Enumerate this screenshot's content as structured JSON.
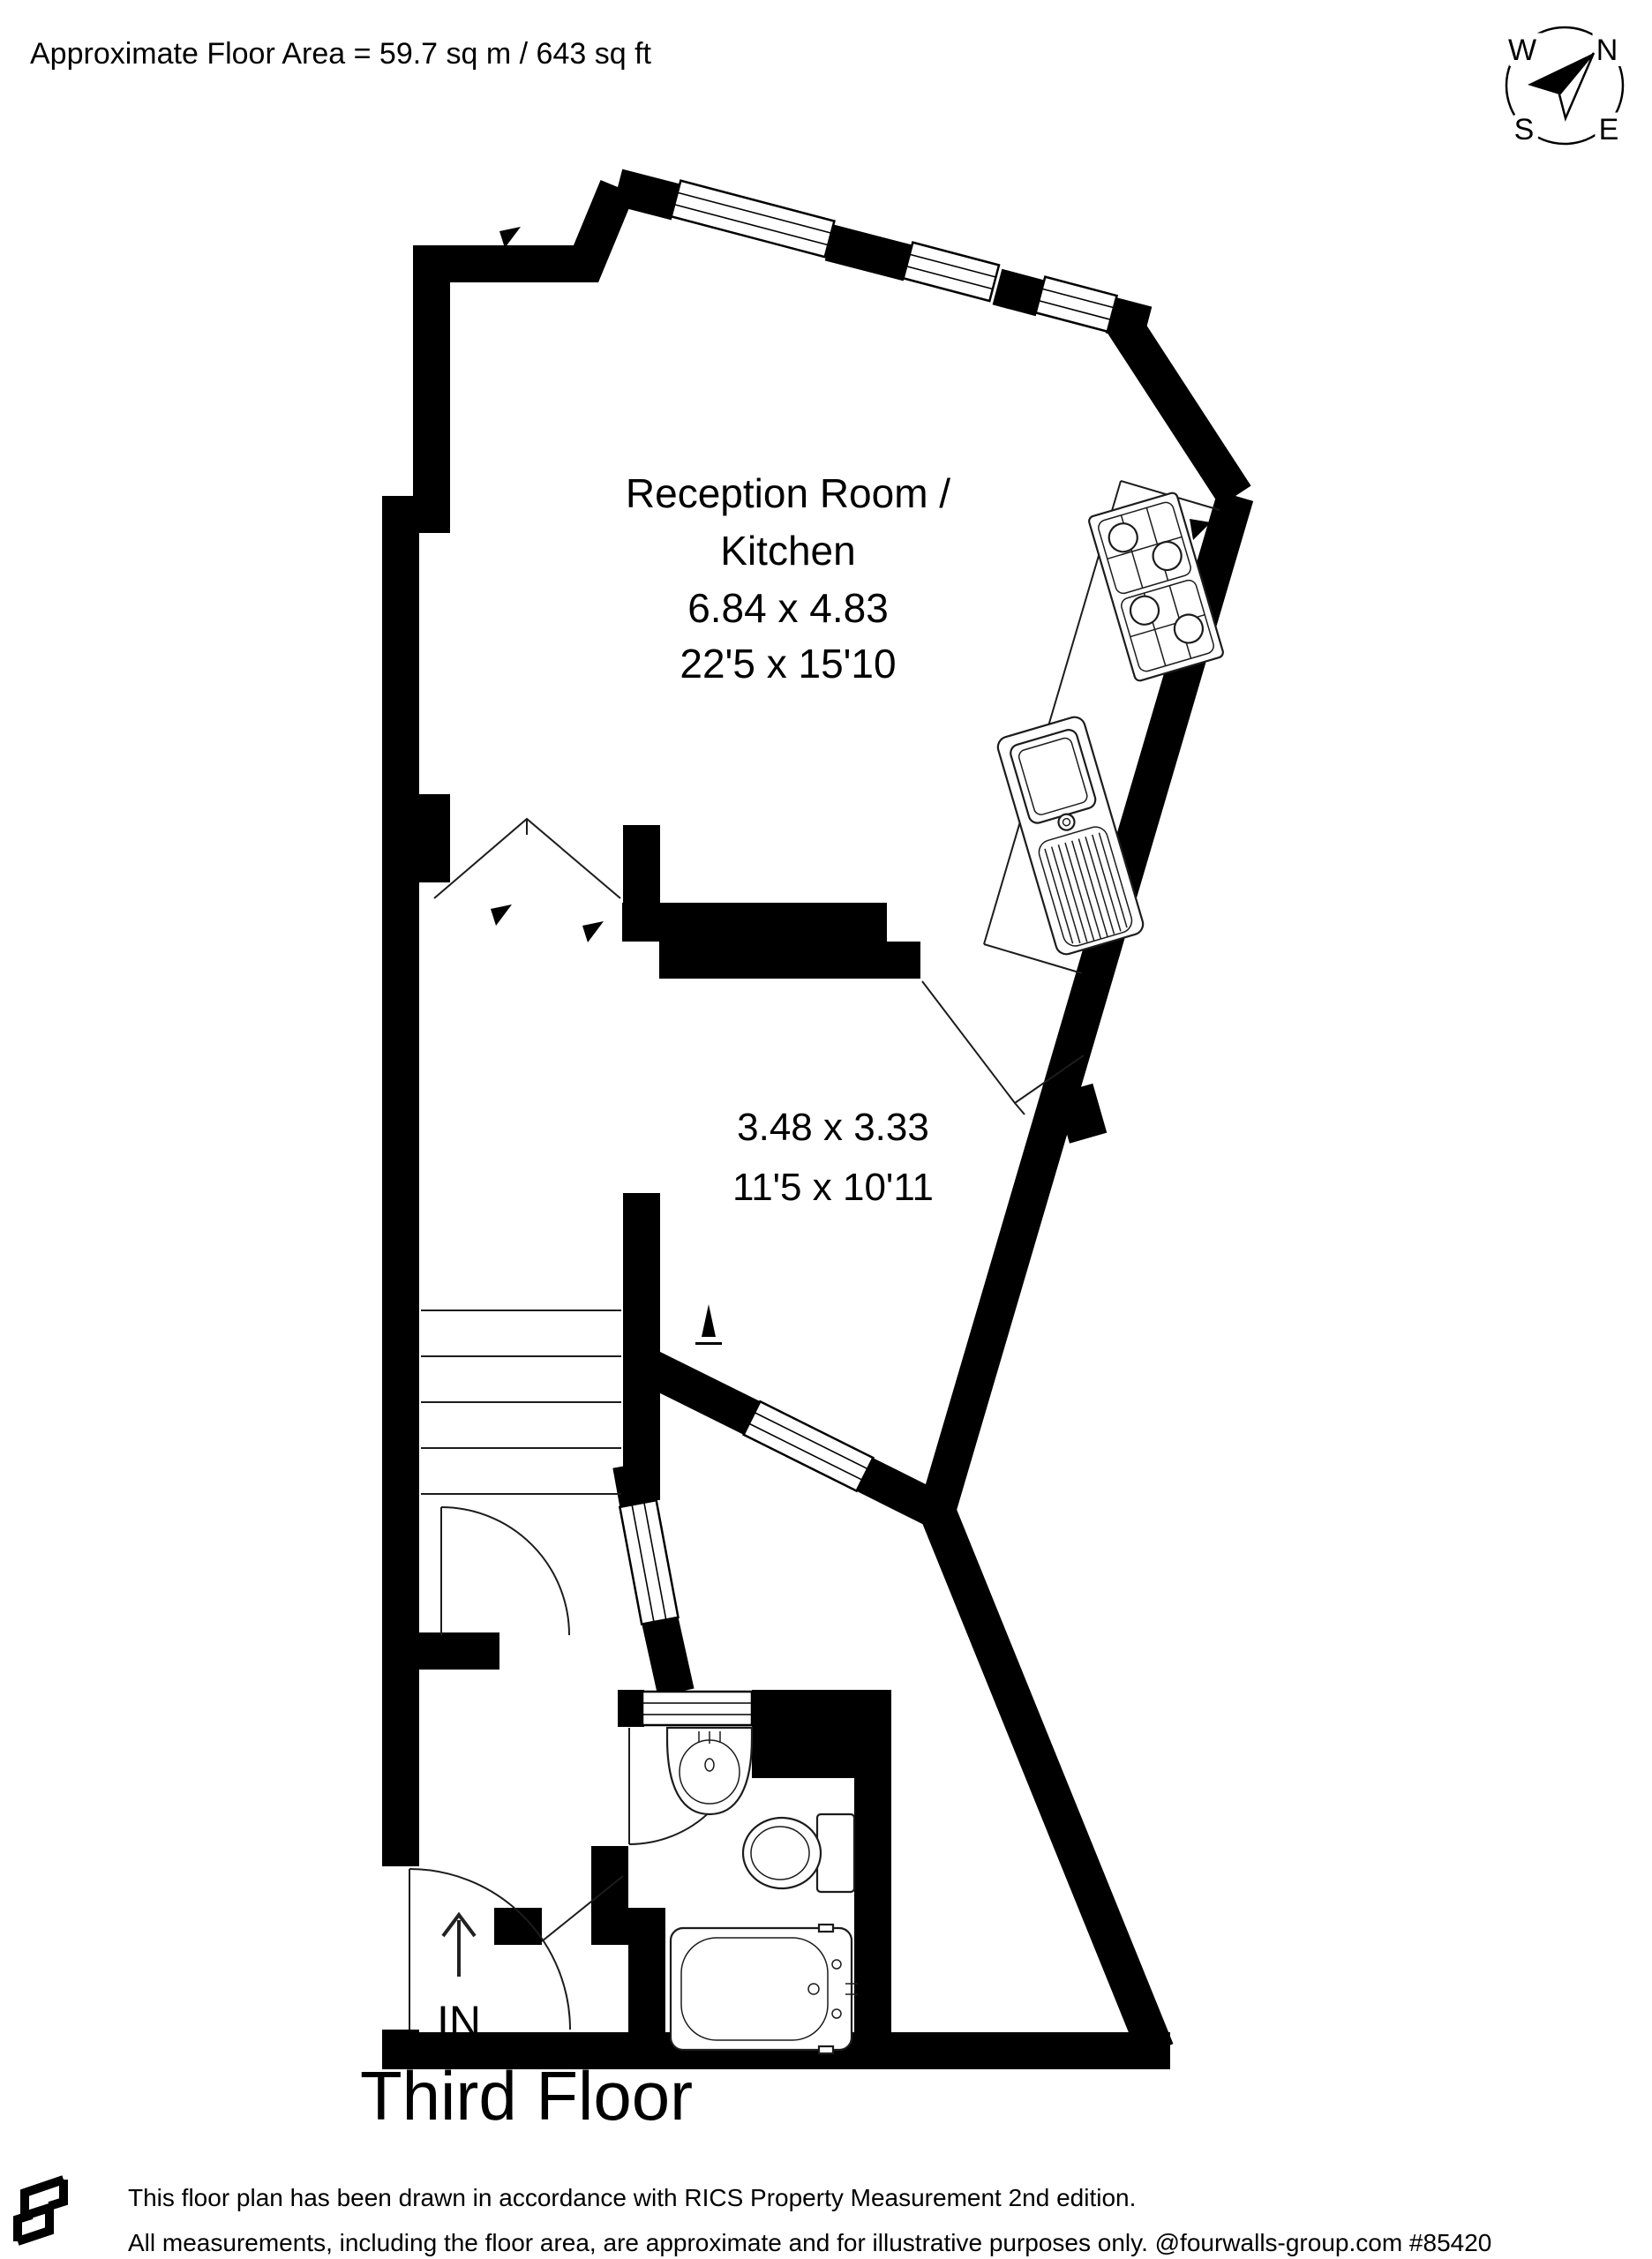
{
  "header": {
    "floor_area": "Approximate Floor Area = 59.7 sq m / 643 sq ft"
  },
  "compass": {
    "n": "N",
    "e": "E",
    "s": "S",
    "w": "W"
  },
  "rooms": {
    "reception": {
      "name_line1": "Reception Room /",
      "name_line2": "Kitchen",
      "metric": "6.84 x 4.83",
      "imperial": "22'5 x 15'10"
    },
    "bedroom": {
      "metric": "3.48 x 3.33",
      "imperial": "11'5 x 10'11"
    }
  },
  "entrance": {
    "label": "IN"
  },
  "floor_title": "Third Floor",
  "footer": {
    "line1": "This floor plan has been drawn in accordance with RICS Property Measurement 2nd edition.",
    "line2": "All measurements, including the floor area, are approximate and for illustrative purposes only. @fourwalls-group.com #85420"
  },
  "colors": {
    "wall": "#000000",
    "line": "#1c1c1c",
    "background": "#ffffff"
  }
}
